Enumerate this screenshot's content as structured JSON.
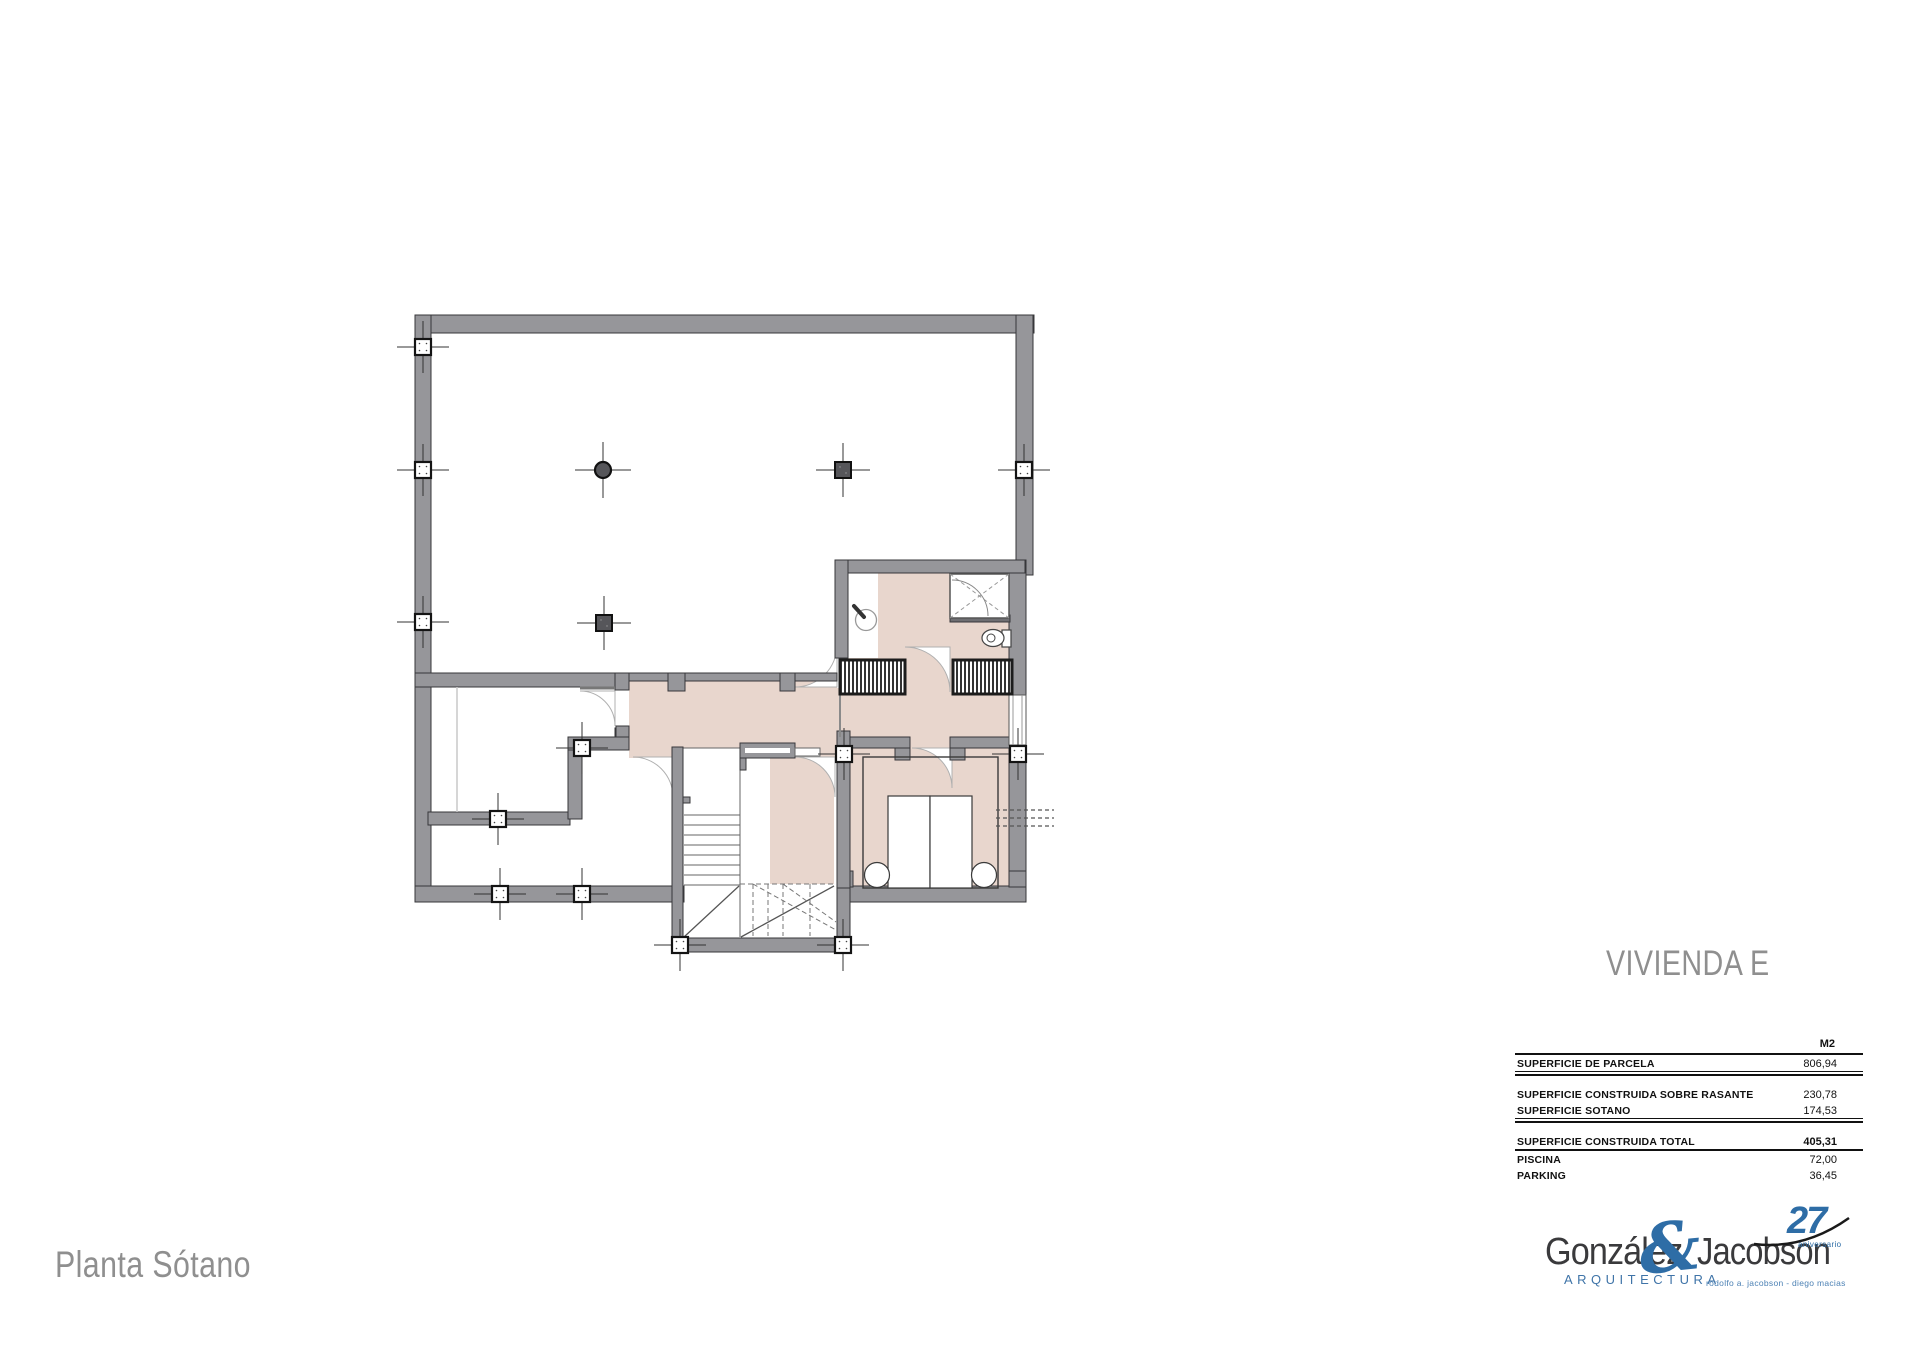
{
  "sheet": {
    "project_title": "VIVIENDA E",
    "floor_label": "Planta Sótano"
  },
  "areas_table": {
    "unit_header": "M2",
    "rows": [
      {
        "label": "SUPERFICIE DE PARCELA",
        "value": "806,94"
      },
      {
        "label": "SUPERFICIE CONSTRUIDA SOBRE RASANTE",
        "value": "230,78"
      },
      {
        "label": "SUPERFICIE SOTANO",
        "value": "174,53"
      },
      {
        "label": "SUPERFICIE CONSTRUIDA TOTAL",
        "value": "405,31"
      },
      {
        "label": "PISCINA",
        "value": "72,00"
      },
      {
        "label": "PARKING",
        "value": "36,45"
      }
    ]
  },
  "logo": {
    "name_left": "González",
    "ampersand": "&",
    "name_right": "Jacobson",
    "anniversary_number": "27",
    "anniversary_word": "aniversario",
    "discipline": "ARQUITECTURA",
    "partners": "rodolfo a. jacobson - diego macias"
  },
  "colors": {
    "wall_gray": "#96969a",
    "floor_pink": "#e8d6cd",
    "brand_blue": "#2e6da6",
    "caption_gray": "#8f8f8f"
  }
}
